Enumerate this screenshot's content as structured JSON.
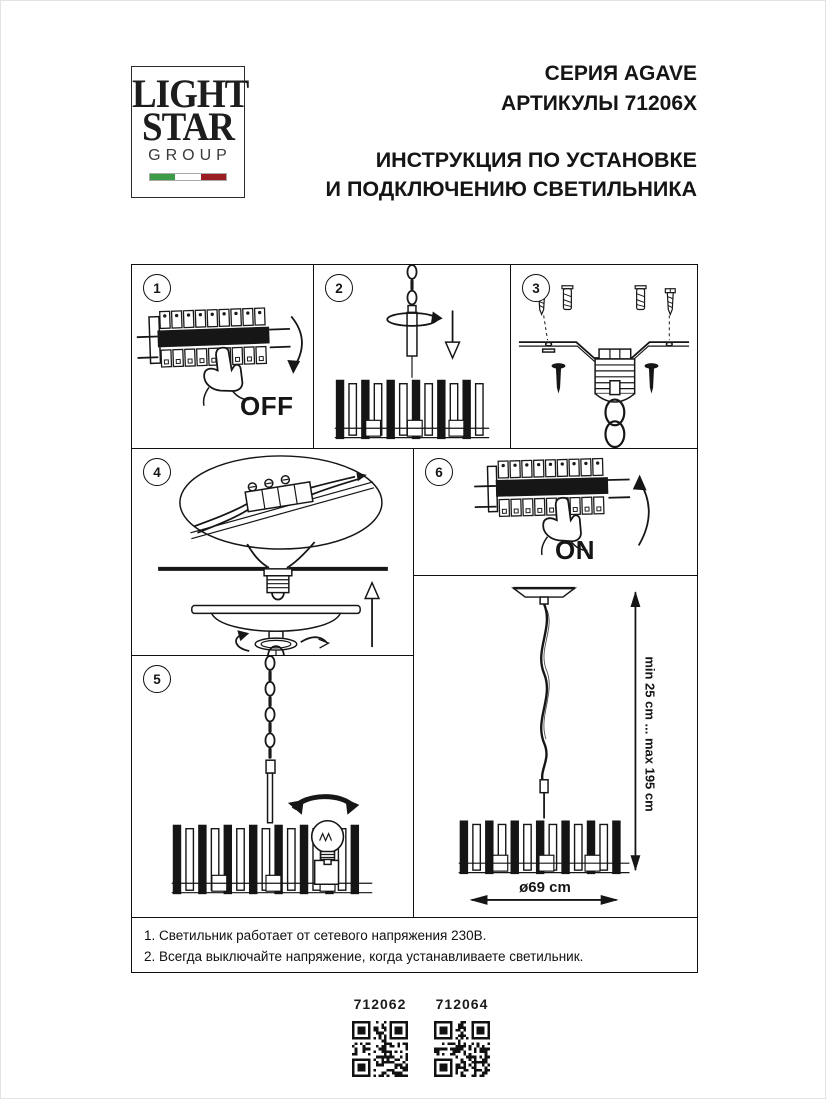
{
  "logo": {
    "line1": "LIGHT",
    "line2": "STAR",
    "line3": "GROUP"
  },
  "header": {
    "series": "СЕРИЯ AGAVE",
    "articles": "АРТИКУЛЫ 71206X",
    "title_line1": "ИНСТРУКЦИЯ ПО УСТАНОВКЕ",
    "title_line2": "И ПОДКЛЮЧЕНИЮ СВЕТИЛЬНИКА"
  },
  "steps": {
    "one": {
      "num": "1",
      "label": "OFF"
    },
    "two": {
      "num": "2"
    },
    "three": {
      "num": "3"
    },
    "four": {
      "num": "4"
    },
    "five": {
      "num": "5"
    },
    "six": {
      "num": "6",
      "label": "ON"
    }
  },
  "dimensions": {
    "height_range": "min 25 cm ... max 195 cm",
    "diameter": "ø69 cm"
  },
  "notes": {
    "line1": "1. Светильник работает от сетевого напряжения 230В.",
    "line2": "2. Всегда выключайте напряжение, когда устанавливаете светильник."
  },
  "products": {
    "left": {
      "code": "712062"
    },
    "right": {
      "code": "712064"
    }
  },
  "colors": {
    "ink": "#1a1a1a",
    "flag_green": "#3d9a47",
    "flag_white": "#ffffff",
    "flag_red": "#9a1d22"
  }
}
